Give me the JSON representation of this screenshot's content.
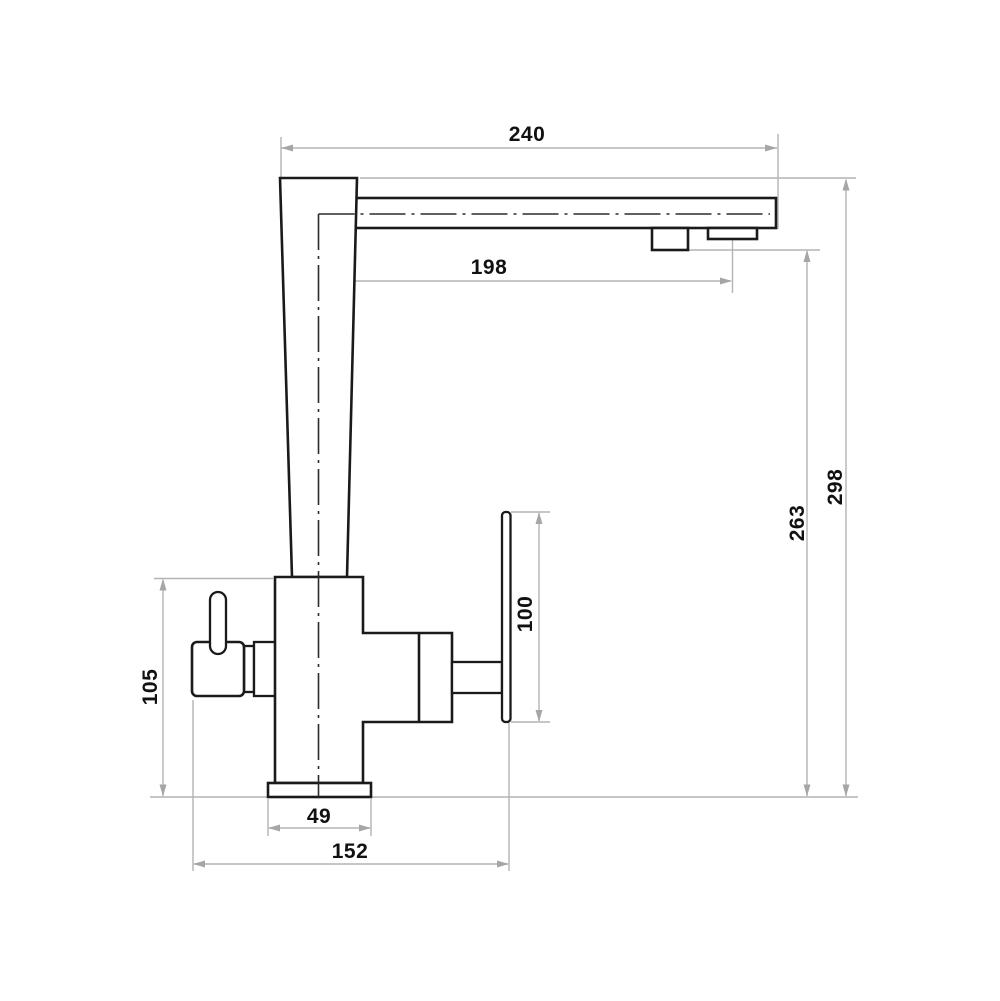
{
  "drawing": {
    "type": "technical-dimension-drawing",
    "subject": "single-lever kitchen faucet, side elevation",
    "colors": {
      "object_line": "#1a1a1a",
      "dimension_line": "#b3b3b3",
      "centerline": "#2b2b2b",
      "label_text": "#111111",
      "background": "#ffffff"
    },
    "dimensions": [
      {
        "id": "spout-reach-overall",
        "label": "240",
        "orientation": "horizontal"
      },
      {
        "id": "outlet-offset",
        "label": "198",
        "orientation": "horizontal"
      },
      {
        "id": "overall-height",
        "label": "298",
        "orientation": "vertical"
      },
      {
        "id": "outlet-height",
        "label": "263",
        "orientation": "vertical"
      },
      {
        "id": "handle-length",
        "label": "100",
        "orientation": "vertical"
      },
      {
        "id": "side-valve-height",
        "label": "105",
        "orientation": "vertical"
      },
      {
        "id": "base-width",
        "label": "49",
        "orientation": "horizontal"
      },
      {
        "id": "overall-depth",
        "label": "152",
        "orientation": "horizontal"
      }
    ]
  }
}
